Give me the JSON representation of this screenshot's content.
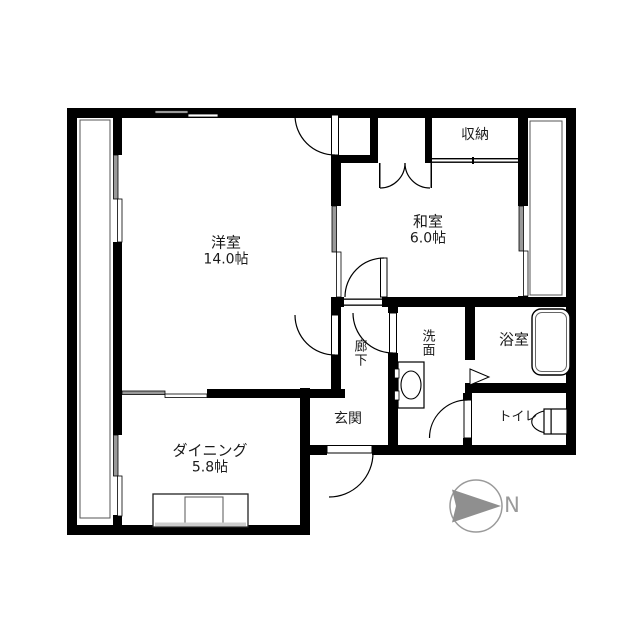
{
  "rooms": {
    "western": {
      "label": "洋室",
      "size": "14.0帖"
    },
    "japanese": {
      "label": "和室",
      "size": "6.0帖"
    },
    "storage": {
      "label": "収納"
    },
    "corridor": {
      "label": "廊下"
    },
    "washroom": {
      "label": "洗面"
    },
    "bathroom": {
      "label": "浴室"
    },
    "toilet": {
      "label": "トイレ"
    },
    "entrance": {
      "label": "玄関"
    },
    "dining": {
      "label": "ダイニング",
      "size": "5.8帖"
    }
  },
  "compass": {
    "label": "N"
  },
  "colors": {
    "wall": "#000000",
    "background": "#ffffff",
    "window_panel": "#999999",
    "compass_gray": "#8f8f8f"
  }
}
